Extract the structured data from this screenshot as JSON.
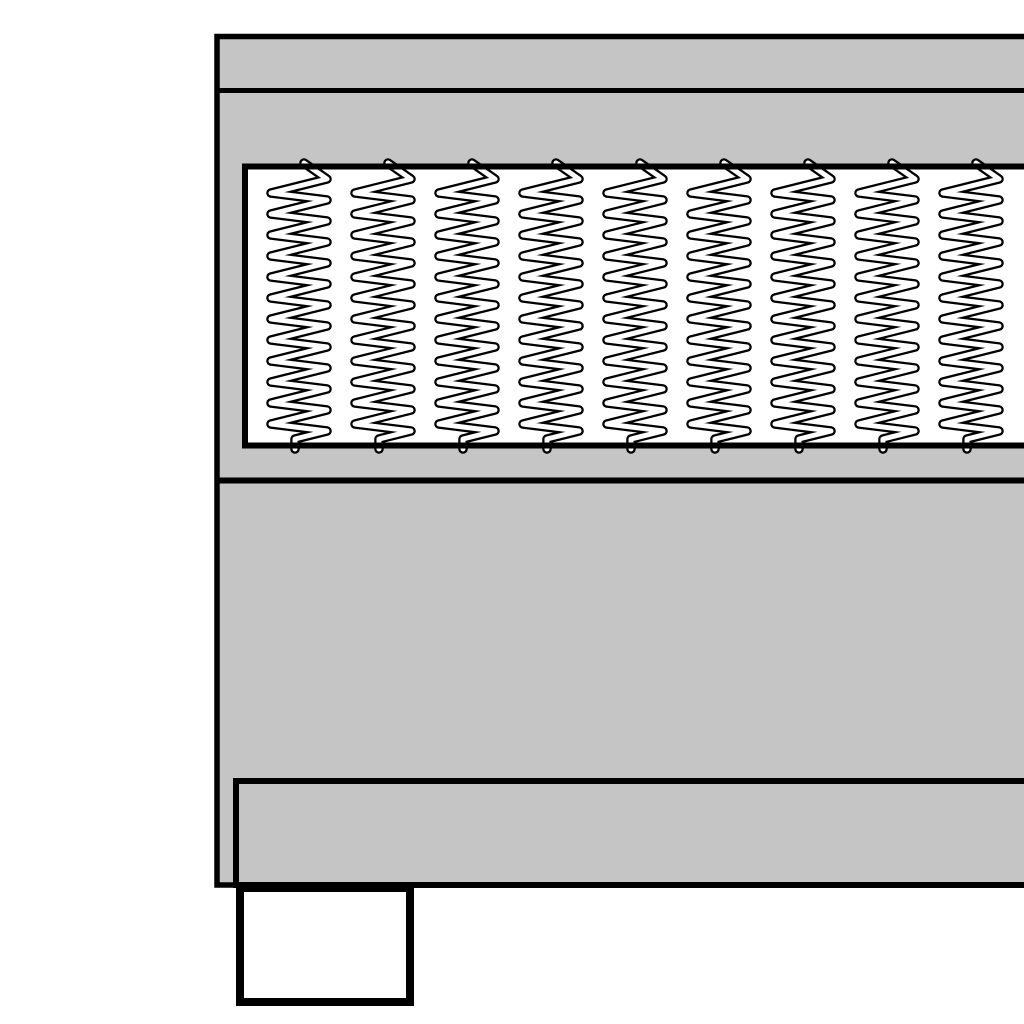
{
  "figure": {
    "name": "box-spring-bed-cross-section",
    "canvas": {
      "width": 1024,
      "height": 1024,
      "background": "#ffffff"
    },
    "colors": {
      "outline": "#000000",
      "upholstery_gray": "#c5c5c5",
      "panel_white": "#ffffff"
    },
    "bed_body": {
      "x": 217,
      "y": 36.5,
      "width": 820,
      "height": 848.5,
      "stroke_width": 5.5
    },
    "top_rail_divider": {
      "x1": 217,
      "y1": 90.5,
      "x2": 1037,
      "y2": 90.5,
      "stroke_width": 5
    },
    "spring_panel": {
      "x": 245,
      "y": 166.5,
      "width": 800,
      "height": 279,
      "stroke_width": 6
    },
    "mattress_base_divider": {
      "x1": 217,
      "y1": 480.5,
      "x2": 1037,
      "y2": 480.5,
      "stroke_width": 6
    },
    "base_bottom_band": {
      "x": 236,
      "y": 781,
      "width": 801,
      "height": 104,
      "stroke_width": 6
    },
    "bed_leg": {
      "x": 240,
      "y": 888,
      "width": 170,
      "height": 114,
      "stroke_width": 8
    },
    "springs": {
      "count": 9,
      "first_center_x": 299,
      "spacing": 84,
      "half_width": 28,
      "top_stub_offset_x": 5,
      "top_y": 163,
      "first_right_vertex_y": 179,
      "period": 21,
      "descend": 14,
      "turns": 13,
      "hook_offset_x": -4,
      "hook_y": 439,
      "bottom_y": 449,
      "outline_width": 9.5,
      "core_width": 5
    }
  }
}
